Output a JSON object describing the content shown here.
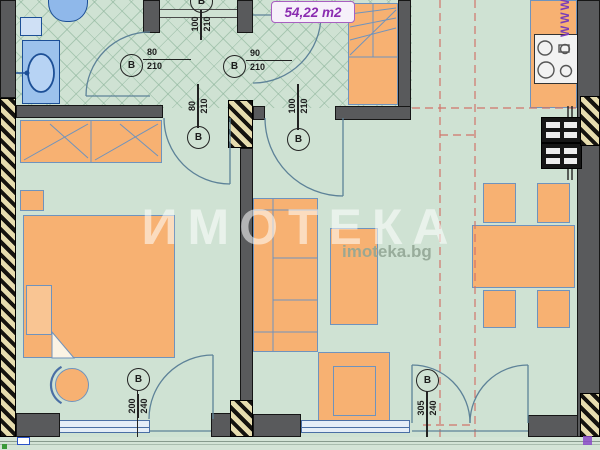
{
  "area_label": "54,22 m2",
  "watermark": {
    "brand": "ИМОТЕКА",
    "site": "imoteka.bg",
    "side_text": "WWW"
  },
  "doors": {
    "bath": {
      "letter": "В",
      "w": "80",
      "h": "210"
    },
    "storage": {
      "letter": "В",
      "w": "90",
      "h": "210"
    },
    "entrance": {
      "letter": "В",
      "w": "100",
      "h": "210"
    },
    "bedroom": {
      "letter": "В",
      "w": "80",
      "h": "210"
    },
    "living": {
      "letter": "В",
      "w": "100",
      "h": "210"
    },
    "bedroom_balcony": {
      "letter": "В",
      "w": "200",
      "h": "240"
    },
    "living_balcony": {
      "letter": "В",
      "w": "305",
      "h": "240"
    }
  },
  "colors": {
    "floor": "#cfe2d3",
    "wall": "#595a5c",
    "furniture": "#f7b172",
    "fixture": "#9cc2ec",
    "accent_purple": "#8a2bb0",
    "dashed_red": "#d1746a",
    "outline_blue": "#6f93bd"
  }
}
